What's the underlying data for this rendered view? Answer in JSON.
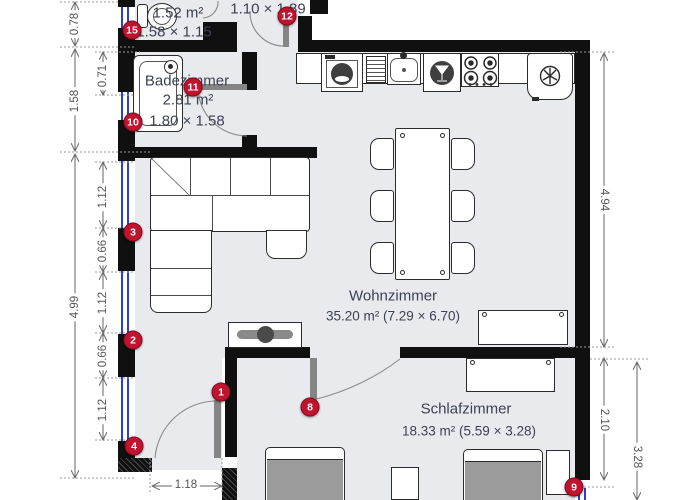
{
  "rooms": {
    "wc": {
      "area": "1.52 m²",
      "size": "1.58 × 1.15"
    },
    "hall": {
      "size": "1.10 × 1.89"
    },
    "bath": {
      "name": "Badezimmer",
      "area": "2.81 m²",
      "size": "1.80 × 1.58"
    },
    "living": {
      "name": "Wohnzimmer",
      "area_size": "35.20 m² (7.29 × 6.70)"
    },
    "bed": {
      "name": "Schlafzimmer",
      "area_size": "18.33 m² (5.59 × 3.28)"
    }
  },
  "markers": {
    "m1": "1",
    "m2": "2",
    "m3": "3",
    "m4": "4",
    "m8": "8",
    "m9": "9",
    "m10": "10",
    "m11": "11",
    "m12": "12",
    "m15": "15"
  },
  "dims": {
    "left_outer": [
      "0.78",
      "1.58",
      "4.99"
    ],
    "left_inner": [
      "0.71",
      "1.12",
      "0.66",
      "1.12",
      "0.66",
      "1.12"
    ],
    "right": [
      "4.94",
      "2.10",
      "3.28"
    ],
    "bottom": [
      "1.18"
    ]
  },
  "colors": {
    "wall": "#101010",
    "floor": "#e9eaee",
    "window_blue": "#2b3fd0",
    "marker_red": "#c0132e",
    "door_gray": "#858585"
  }
}
